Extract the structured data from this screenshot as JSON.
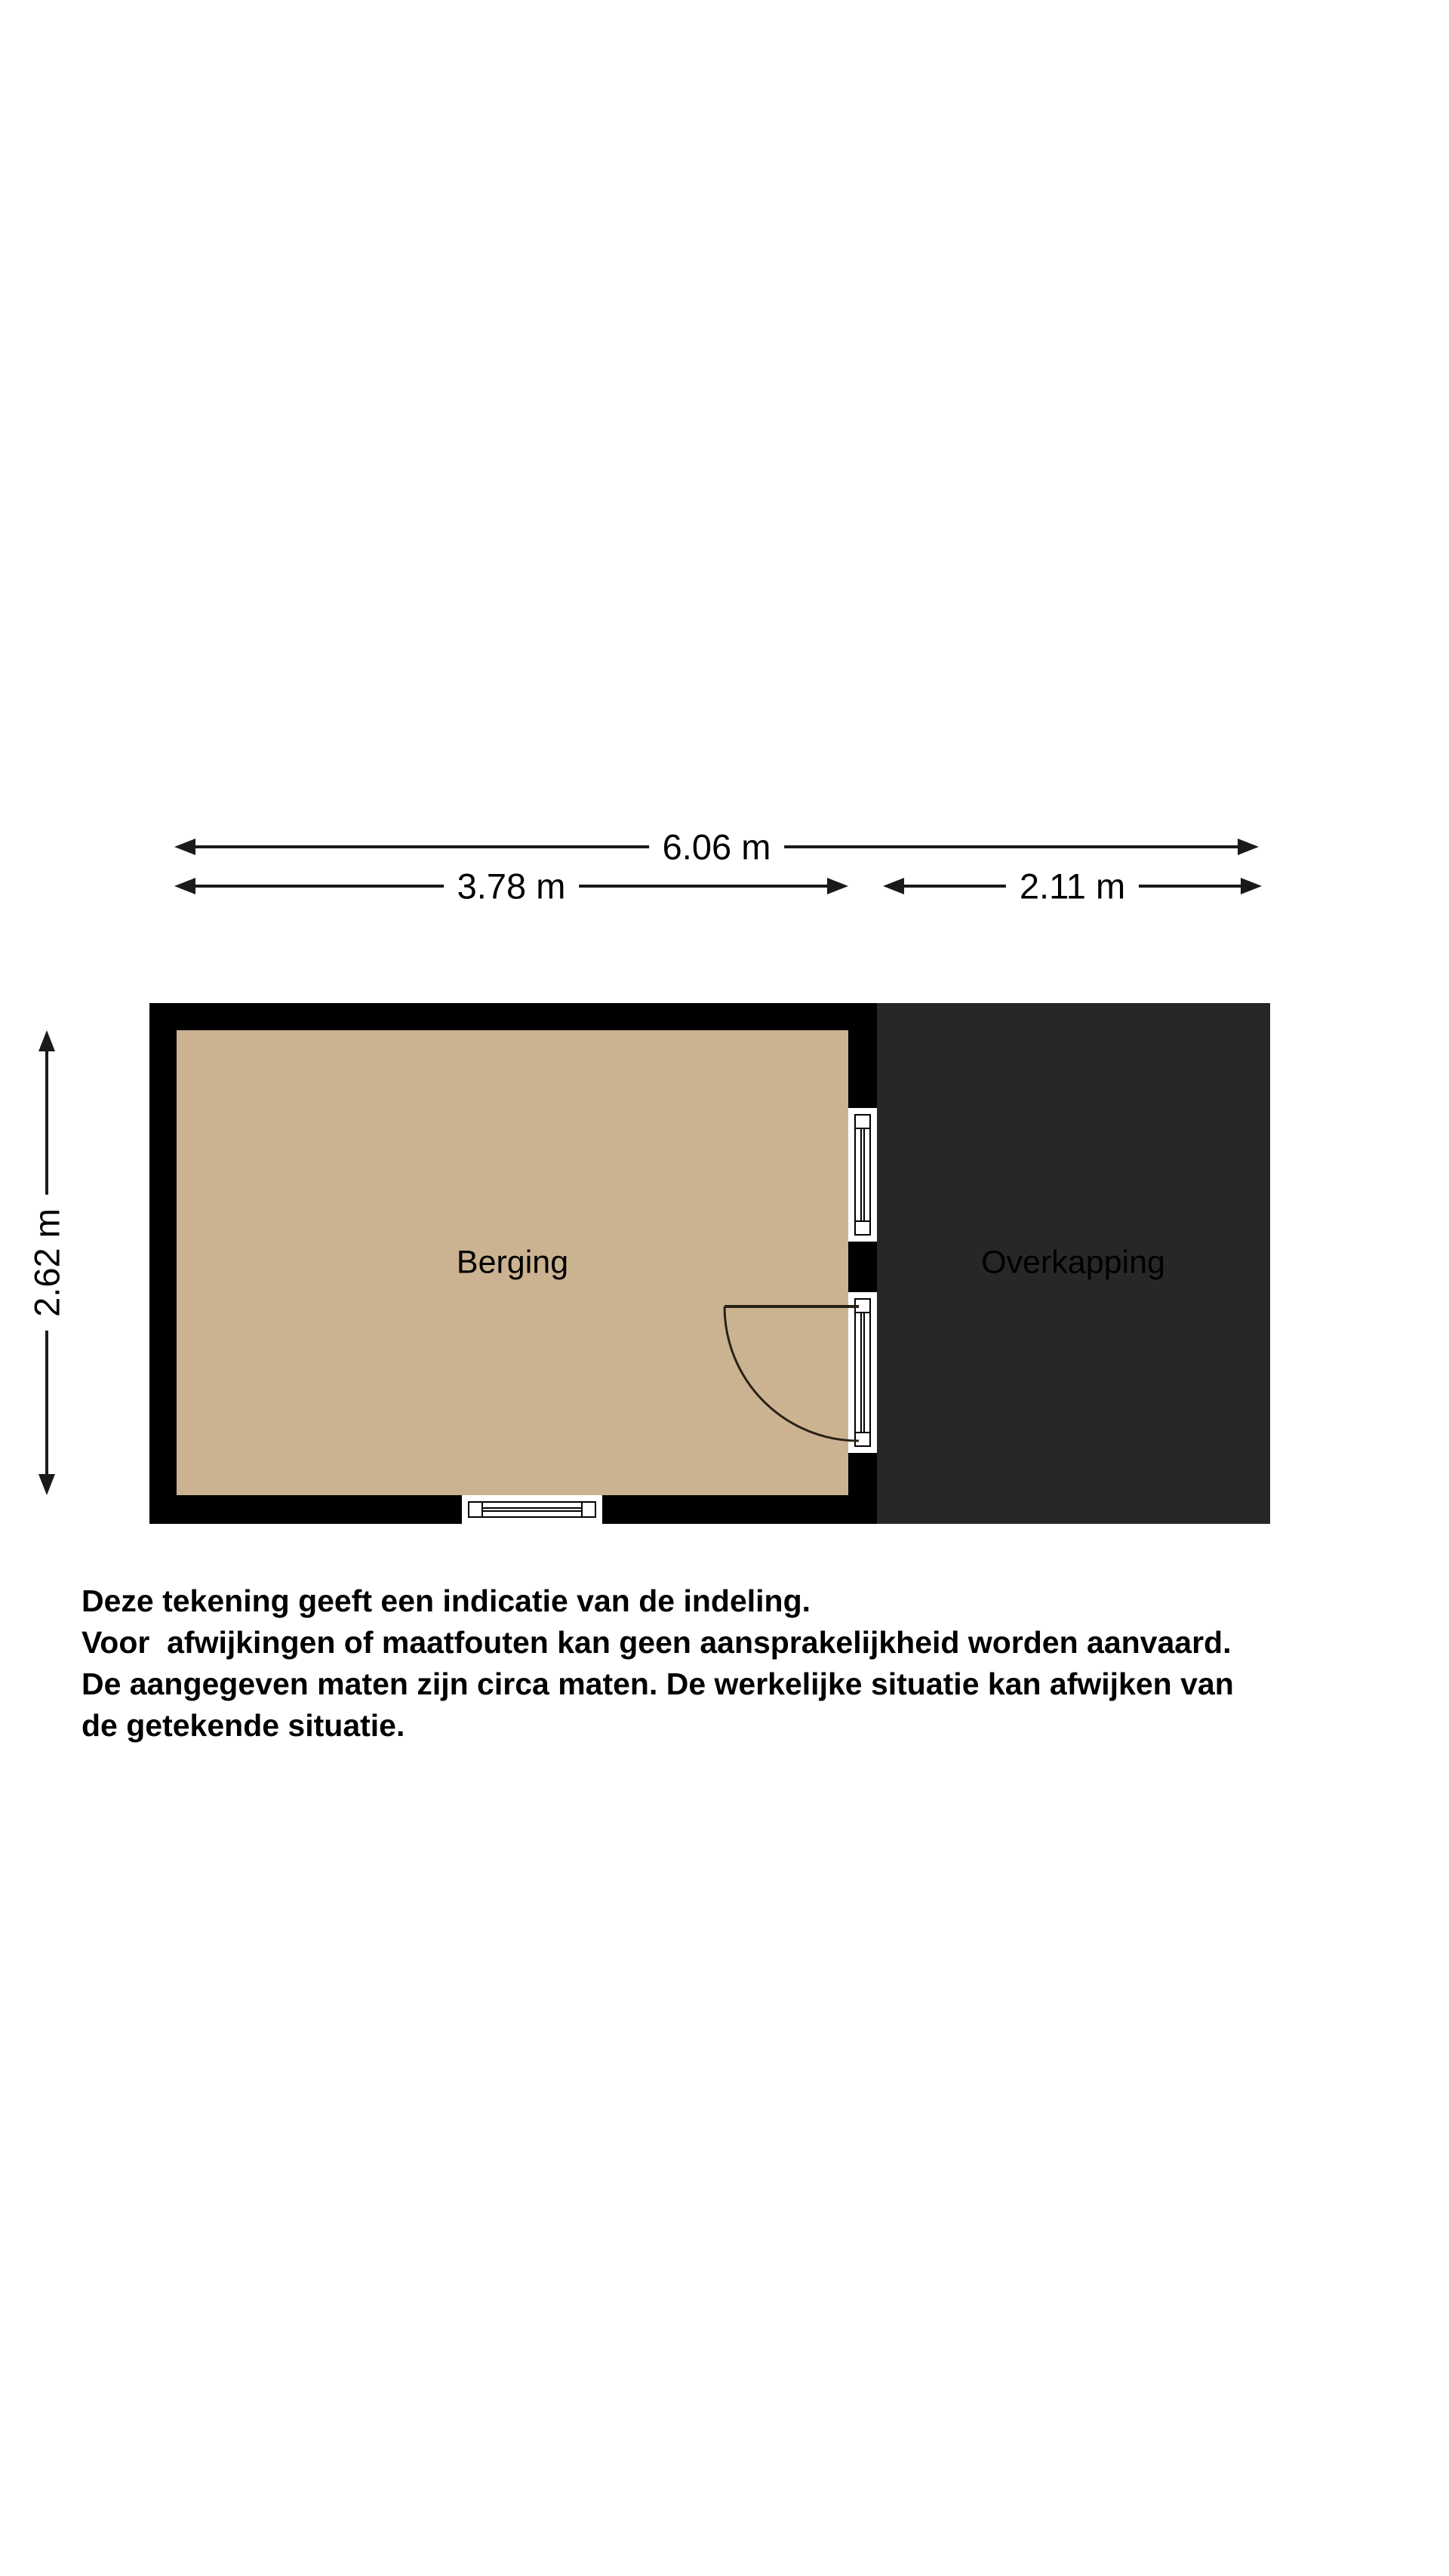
{
  "plan": {
    "rooms": [
      {
        "label": "Berging"
      },
      {
        "label": "Overkapping"
      }
    ],
    "dimensions": {
      "total_width": "6.06 m",
      "berging_width": "3.78 m",
      "overkapping_width": "2.11 m",
      "height": "2.62 m"
    },
    "colors": {
      "floor": "#cbb392",
      "wall": "#000000",
      "overkapping": "#272727",
      "background": "#ffffff",
      "line": "#1a1a1a"
    }
  },
  "disclaimer": {
    "lines": [
      "Deze tekening geeft een indicatie van de indeling.",
      "Voor  afwijkingen of maatfouten kan geen aansprakelijkheid worden aanvaard.",
      "De aangegeven maten zijn circa maten. De werkelijke situatie kan afwijken van",
      "de getekende situatie."
    ]
  }
}
